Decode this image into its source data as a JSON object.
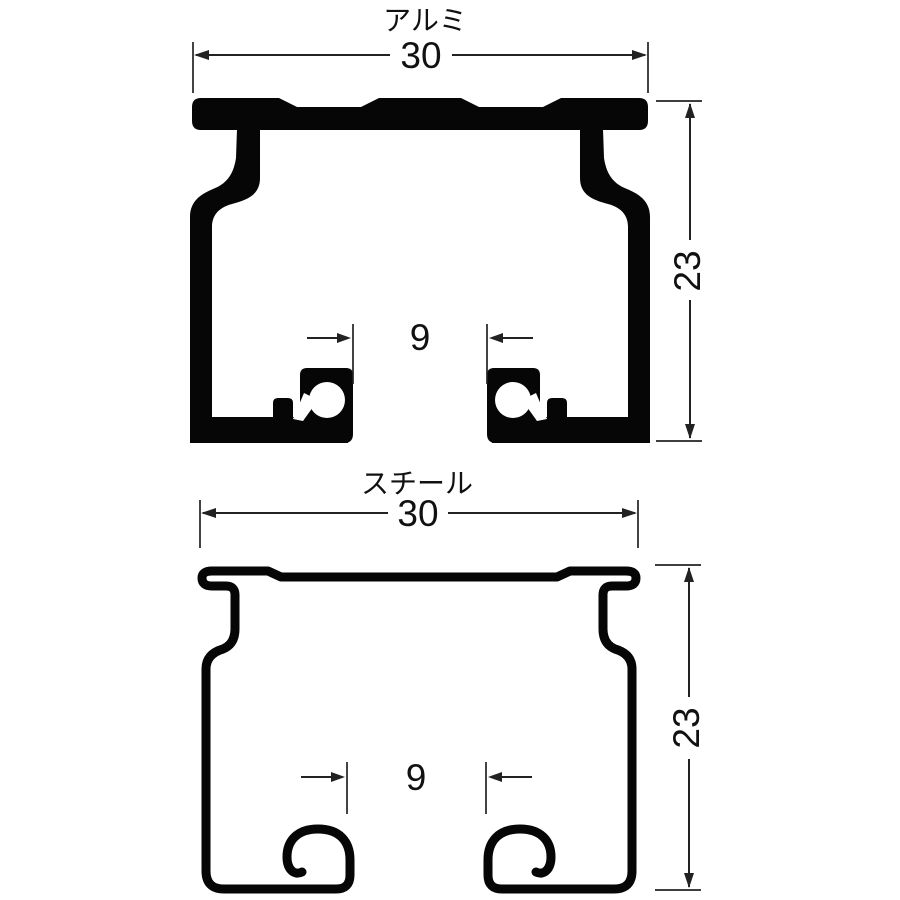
{
  "diagram": {
    "type": "technical-cross-section",
    "description": "Curtain rail cross-section profiles, aluminum and steel",
    "colors": {
      "background": "#ffffff",
      "ink": "#060606",
      "dimension_lines": "#222222"
    },
    "sections": [
      {
        "label": "アルミ",
        "dims": {
          "width": "30",
          "height": "23",
          "slot_width": "9"
        }
      },
      {
        "label": "スチール",
        "dims": {
          "width": "30",
          "height": "23",
          "slot_width": "9"
        }
      }
    ]
  }
}
